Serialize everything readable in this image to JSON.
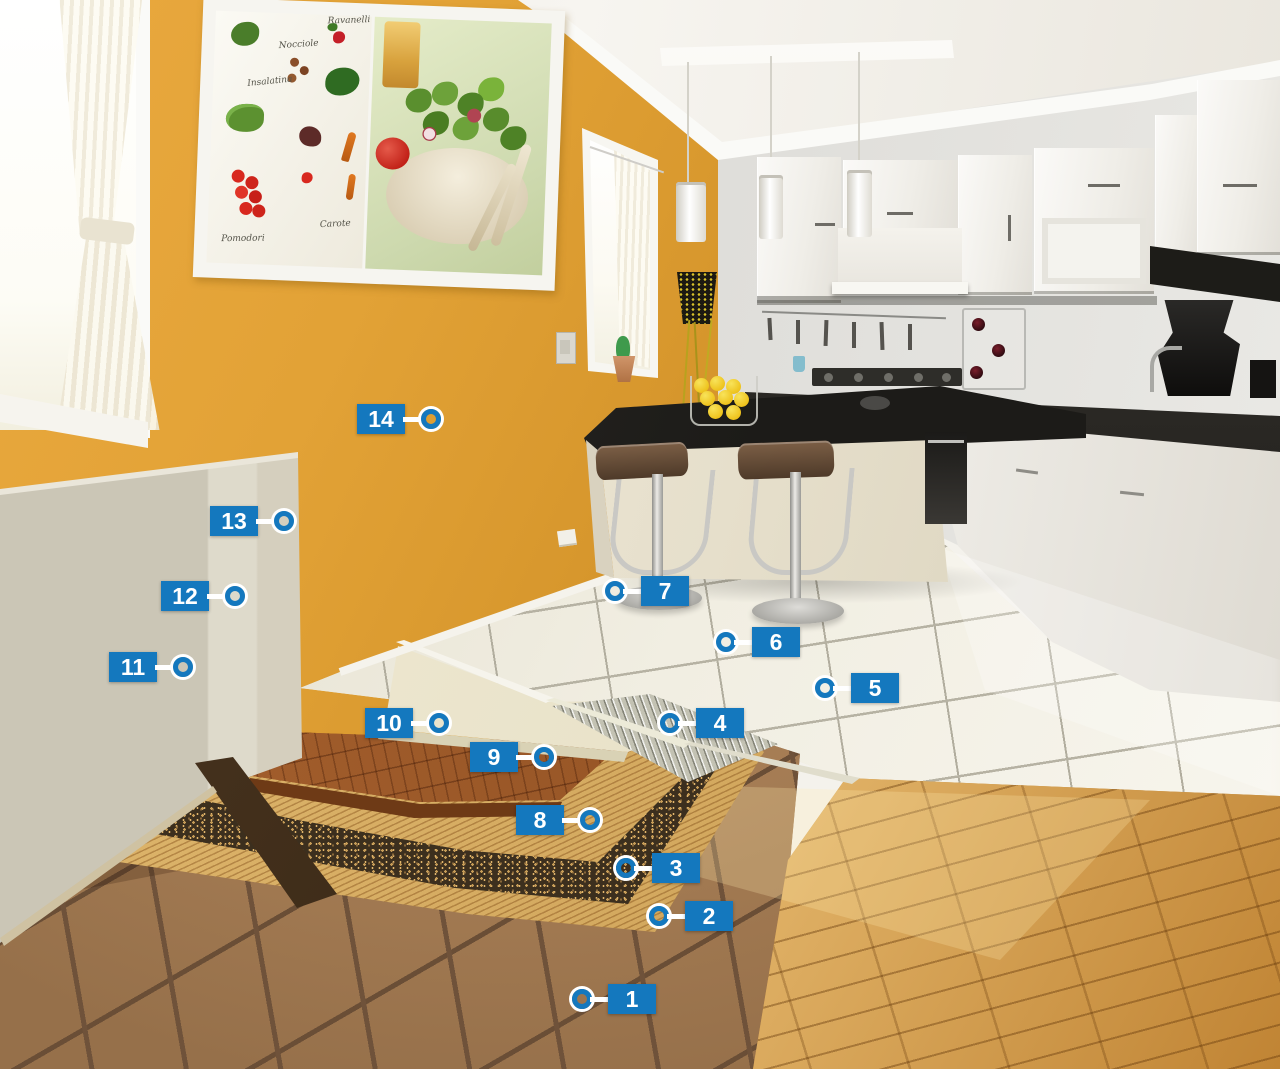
{
  "palette": {
    "callout_blue": "#1478BE",
    "callout_text": "#FFFFFF",
    "wall_orange": "#E2A438",
    "plaster_beige": "#CCC7B7",
    "tile_white": "#ECE8DB",
    "terracotta_brown": "#A1774E",
    "wood_oak": "#C68D3D",
    "cork_dark": "#3C2F1E",
    "adhesive_tan": "#D9AD5E",
    "membrane_gray": "#C3C2B3",
    "counter_black": "#232220",
    "cabinet_white": "#F5F4F0"
  },
  "callouts": [
    {
      "label": "1"
    },
    {
      "label": "2"
    },
    {
      "label": "3"
    },
    {
      "label": "4"
    },
    {
      "label": "5"
    },
    {
      "label": "6"
    },
    {
      "label": "7"
    },
    {
      "label": "8"
    },
    {
      "label": "9"
    },
    {
      "label": "10"
    },
    {
      "label": "11"
    },
    {
      "label": "12"
    },
    {
      "label": "13"
    },
    {
      "label": "14"
    }
  ],
  "picture_frame": {
    "labels": [
      "Ravanelli",
      "Nocciole",
      "Insalatina",
      "Pomodori",
      "Carote"
    ]
  }
}
